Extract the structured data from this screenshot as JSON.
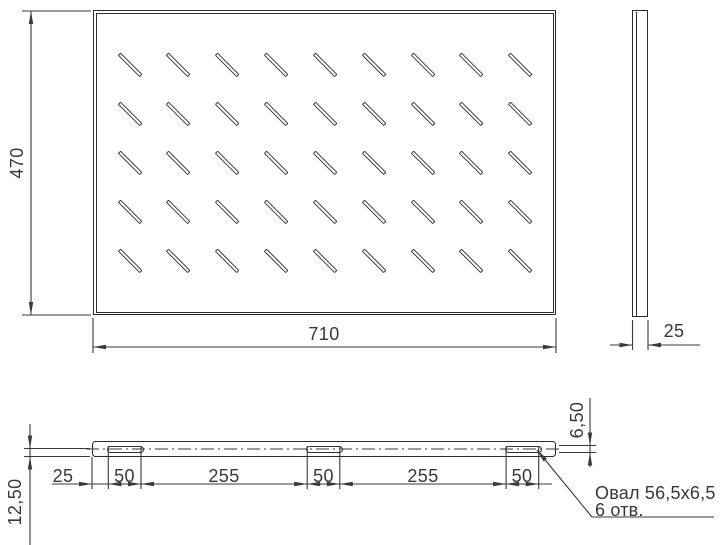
{
  "views": {
    "top": {
      "width_dim": "710",
      "height_dim": "470",
      "slot_rows": 5,
      "slot_cols": 9
    },
    "side": {
      "depth_dim": "25"
    },
    "front": {
      "chain_dims": [
        "25",
        "50",
        "255",
        "50",
        "255",
        "50"
      ],
      "lip_height_dim": "12,50",
      "slot_height_dim": "6,50",
      "oval_count": 3
    }
  },
  "callout": {
    "line1": "Овал 56,5x6,5",
    "line2": "6 отв."
  },
  "colors": {
    "object_line": "#2b2b2b",
    "dimension_line": "#3a3a3a",
    "background": "#ffffff"
  }
}
